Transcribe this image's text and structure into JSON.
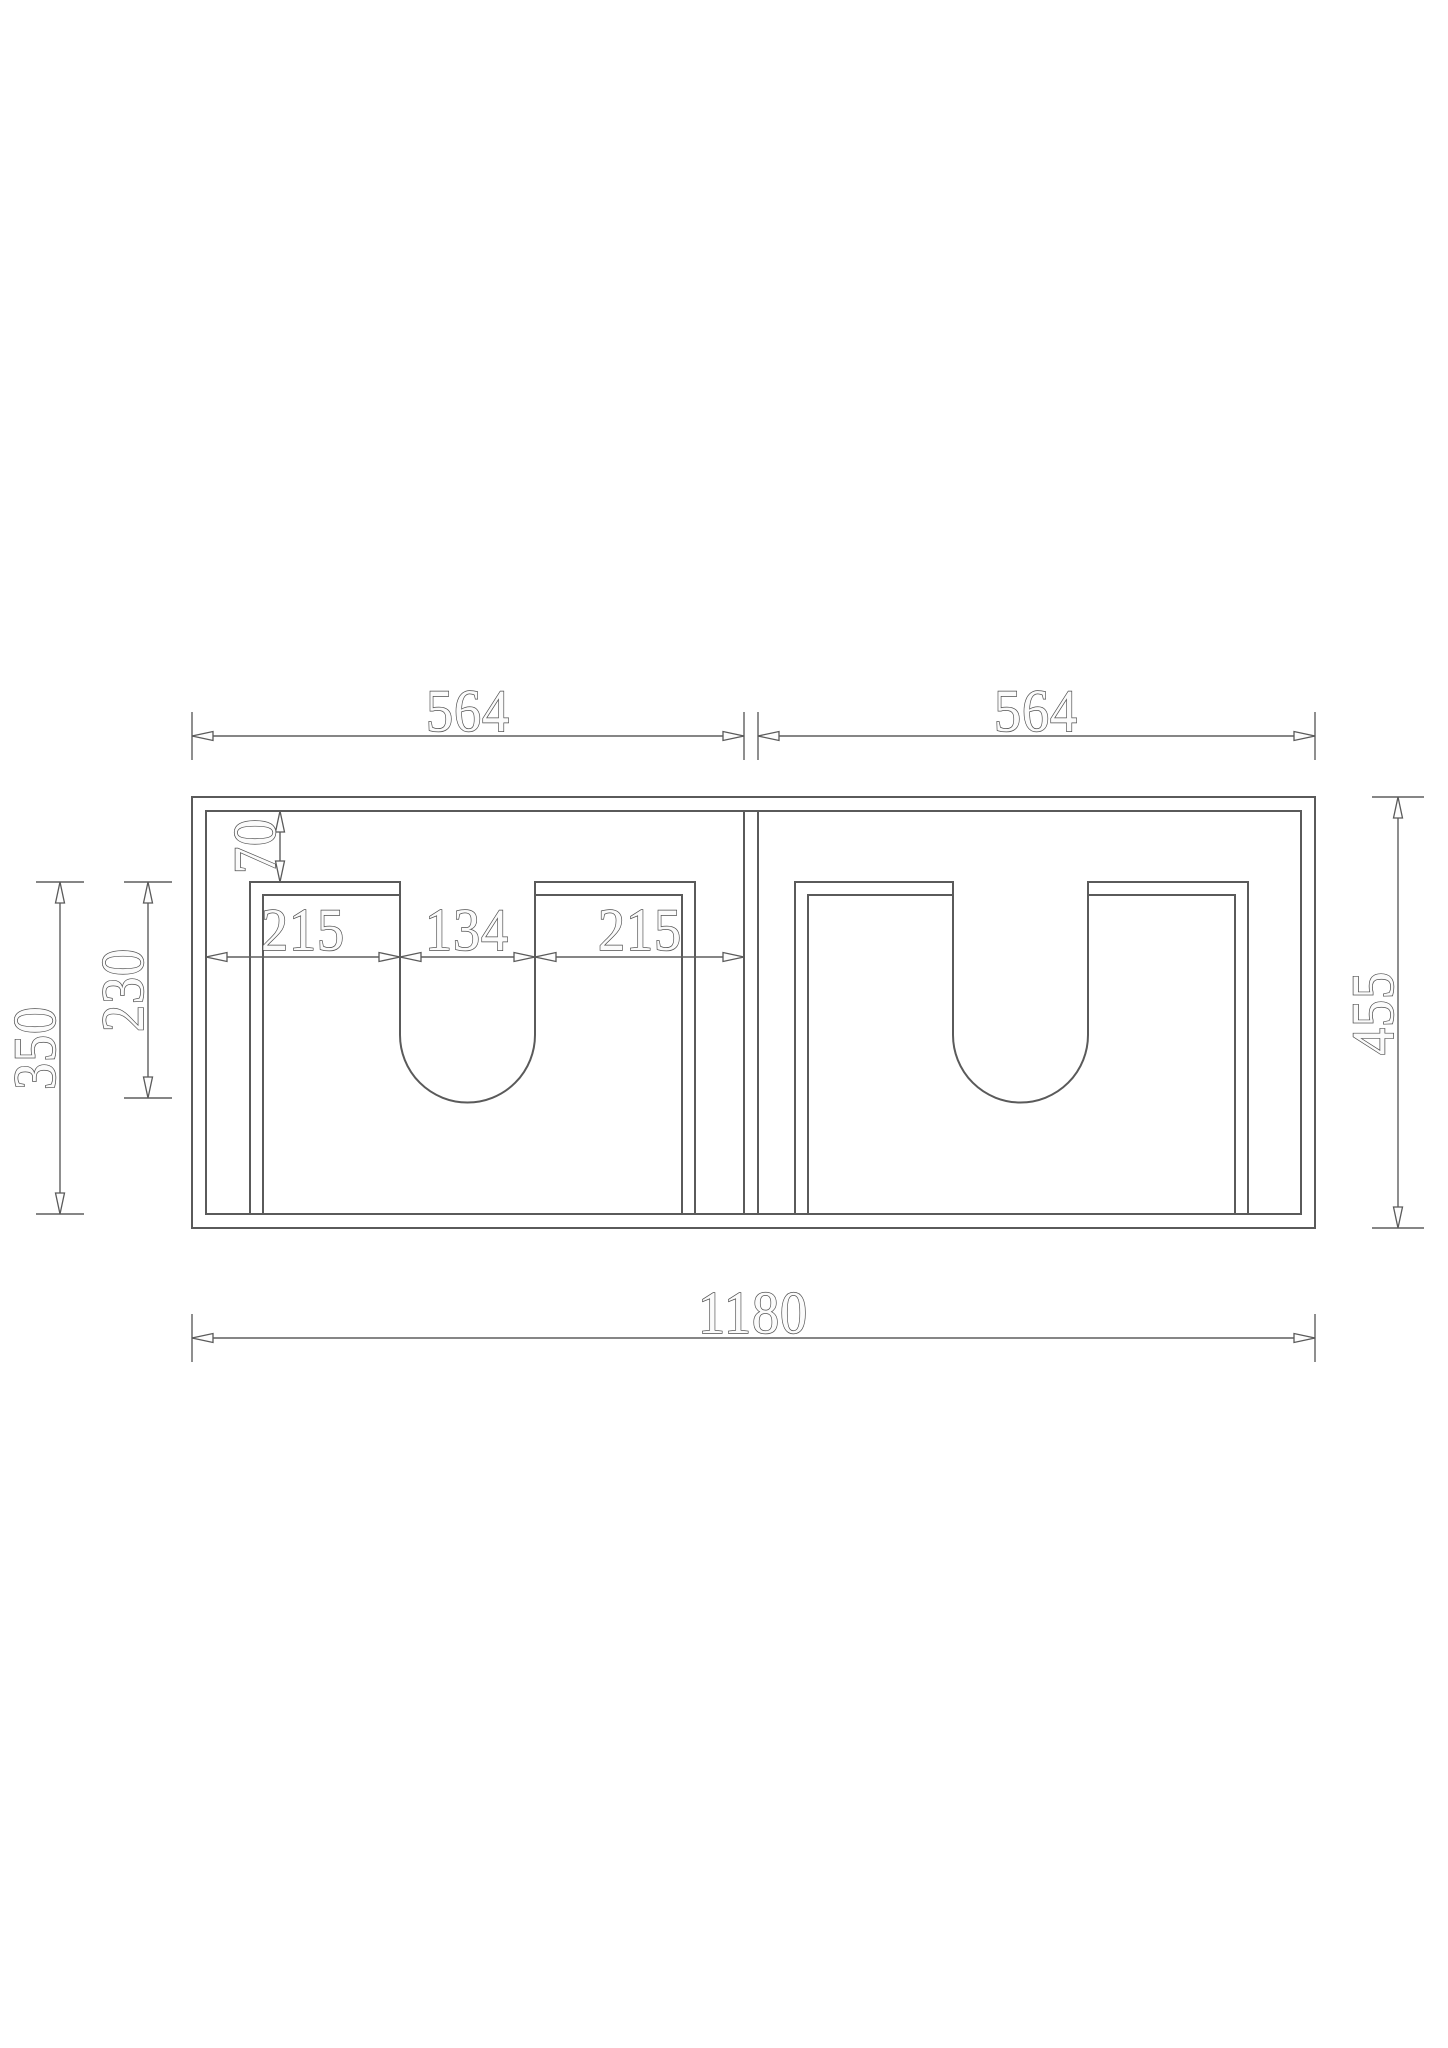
{
  "drawing": {
    "background_color": "#ffffff",
    "line_color": "#5a5a5a",
    "text_fill_color": "#fbfbfb",
    "text_outline_color": "#4f4f4f",
    "dimensions": {
      "left_section_width": "564",
      "right_section_width": "564",
      "top_inset": "70",
      "cutout_left_offset": "215",
      "cutout_width": "134",
      "cutout_right_offset": "215",
      "panel_depth": "350",
      "cutout_depth": "230",
      "overall_depth": "455",
      "overall_width": "1180"
    }
  }
}
